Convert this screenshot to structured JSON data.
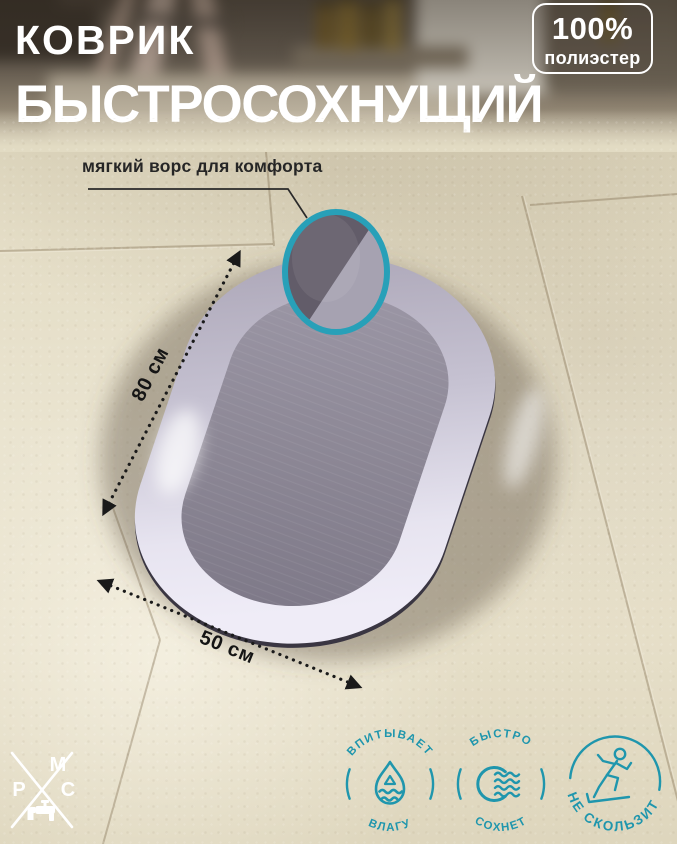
{
  "title": {
    "line1": "КОВРИК",
    "line2": "БЫСТРОСОХНУЩИЙ"
  },
  "badge": {
    "value": "100%",
    "material": "полиэстер"
  },
  "callout": {
    "label": "мягкий ворс для комфорта",
    "target": "texture-magnifier"
  },
  "dimensions": {
    "length_label": "80 см",
    "width_label": "50 см"
  },
  "features": [
    {
      "label_top": "ВПИТЫВАЕТ",
      "label_bottom": "ВЛАГУ",
      "icon": "water-drop-icon"
    },
    {
      "label_top": "БЫСТРО",
      "label_bottom": "СОХНЕТ",
      "icon": "drying-waves-icon"
    },
    {
      "label_arc": "НЕ СКОЛЬЗИТ",
      "icon": "slipping-person-icon"
    }
  ],
  "logo": {
    "letter_top": "М",
    "letter_left": "Р",
    "letter_right": "С",
    "icon": "faucet-icon"
  },
  "colors": {
    "accent_teal": "#1f96ad",
    "magnifier_ring": "#28a0b8",
    "floor_beige": "#e6dfc8",
    "mat_border_light": "#eceaf4",
    "mat_border_dark": "#a8a2b3",
    "mat_surface": "#8d8896",
    "annotation_black": "#1a1a1a",
    "text_white": "#ffffff"
  }
}
